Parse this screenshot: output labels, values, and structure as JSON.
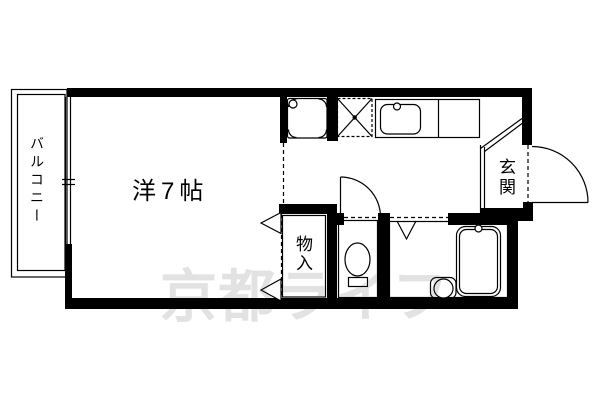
{
  "floorplan": {
    "rooms": {
      "balcony": {
        "label": "バルコニー"
      },
      "western_room": {
        "label": "洋7帖"
      },
      "entrance": {
        "label": "玄関"
      },
      "storage": {
        "label": "物入"
      }
    },
    "watermark": {
      "text": "京都ライフ",
      "color": "#e2e2e2"
    },
    "fixtures": [
      "washing-machine-pan-icon",
      "washer-drain-pan-icon",
      "kitchen-counter-icon",
      "kitchen-sink-icon",
      "toilet-icon",
      "bathtub-icon",
      "wash-stool-icon",
      "balcony-window-icon",
      "entrance-door-icon",
      "toilet-door-icon",
      "closet-folding-door-arrow-icon",
      "bath-door-mark-icon",
      "genkan-step-icon"
    ],
    "colors": {
      "line": "#000000",
      "background": "#ffffff",
      "watermark": "#e2e2e2"
    }
  }
}
